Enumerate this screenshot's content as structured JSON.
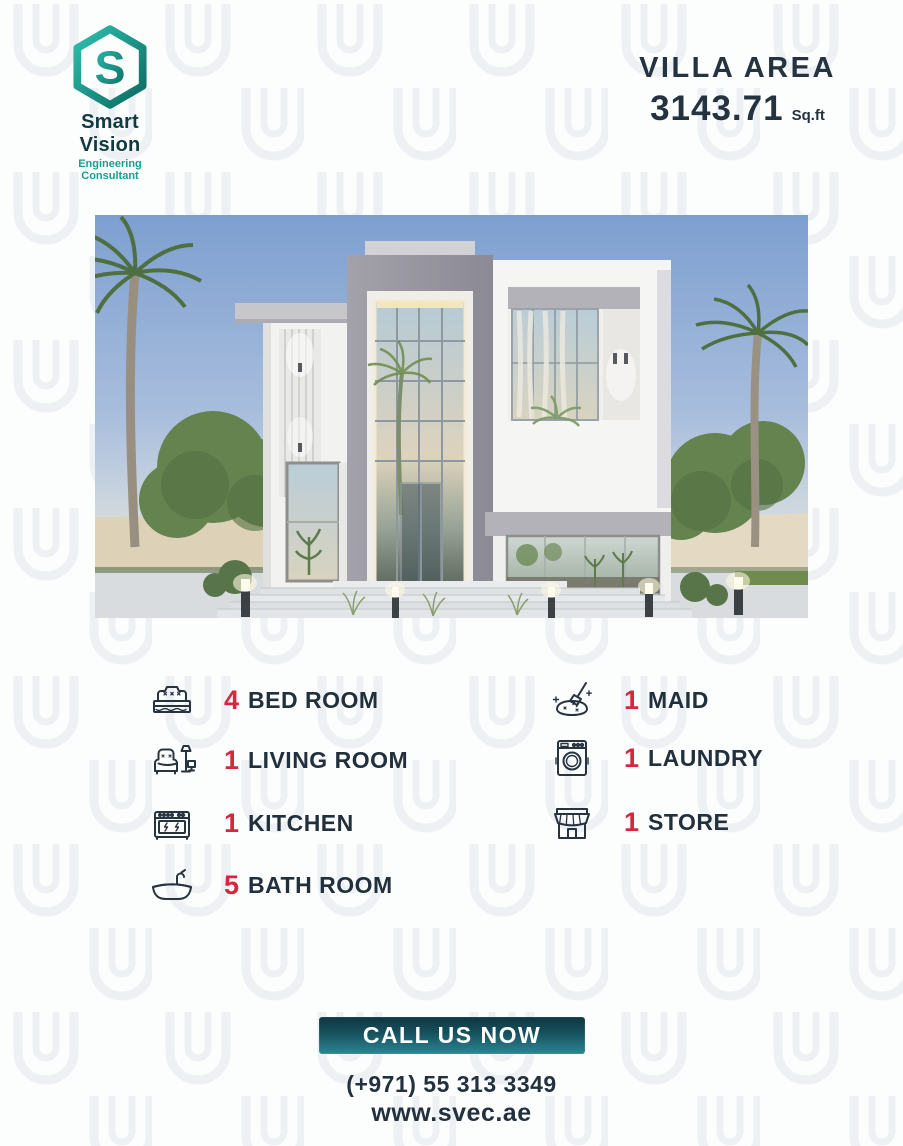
{
  "brand": {
    "name": "Smart Vision",
    "tagline": "Engineering Consultant",
    "logo_icon": "hexagon-s-logo"
  },
  "header": {
    "area_label": "VILLA AREA",
    "area_value": "3143.71",
    "area_unit": "Sq.ft"
  },
  "villa_image": {
    "description": "modern two-storey white villa render with glass atrium, palm trees and bollard lights"
  },
  "features": {
    "left": [
      {
        "count": "4",
        "label": "BED ROOM",
        "icon": "bed-icon"
      },
      {
        "count": "1",
        "label": "LIVING ROOM",
        "icon": "sofa-lamp-icon"
      },
      {
        "count": "1",
        "label": "KITCHEN",
        "icon": "stove-icon"
      },
      {
        "count": "5",
        "label": "BATH ROOM",
        "icon": "bathtub-icon"
      }
    ],
    "right": [
      {
        "count": "1",
        "label": "MAID",
        "icon": "cleaning-icon"
      },
      {
        "count": "1",
        "label": "LAUNDRY",
        "icon": "washing-machine-icon"
      },
      {
        "count": "1",
        "label": "STORE",
        "icon": "storefront-icon"
      }
    ]
  },
  "footer": {
    "cta_label": "CALL US NOW",
    "phone": "(+971) 55 313 3349",
    "website": "www.svec.ae"
  },
  "colors": {
    "accent_red": "#d2293e",
    "text_navy": "#22303d",
    "teal_dark": "#0f6b62",
    "teal_light": "#2fbfae",
    "cta_gradient_top": "#0e3640",
    "cta_gradient_bottom": "#2d8694",
    "background": "#fcfdfd",
    "pattern": "#eef1f4"
  }
}
